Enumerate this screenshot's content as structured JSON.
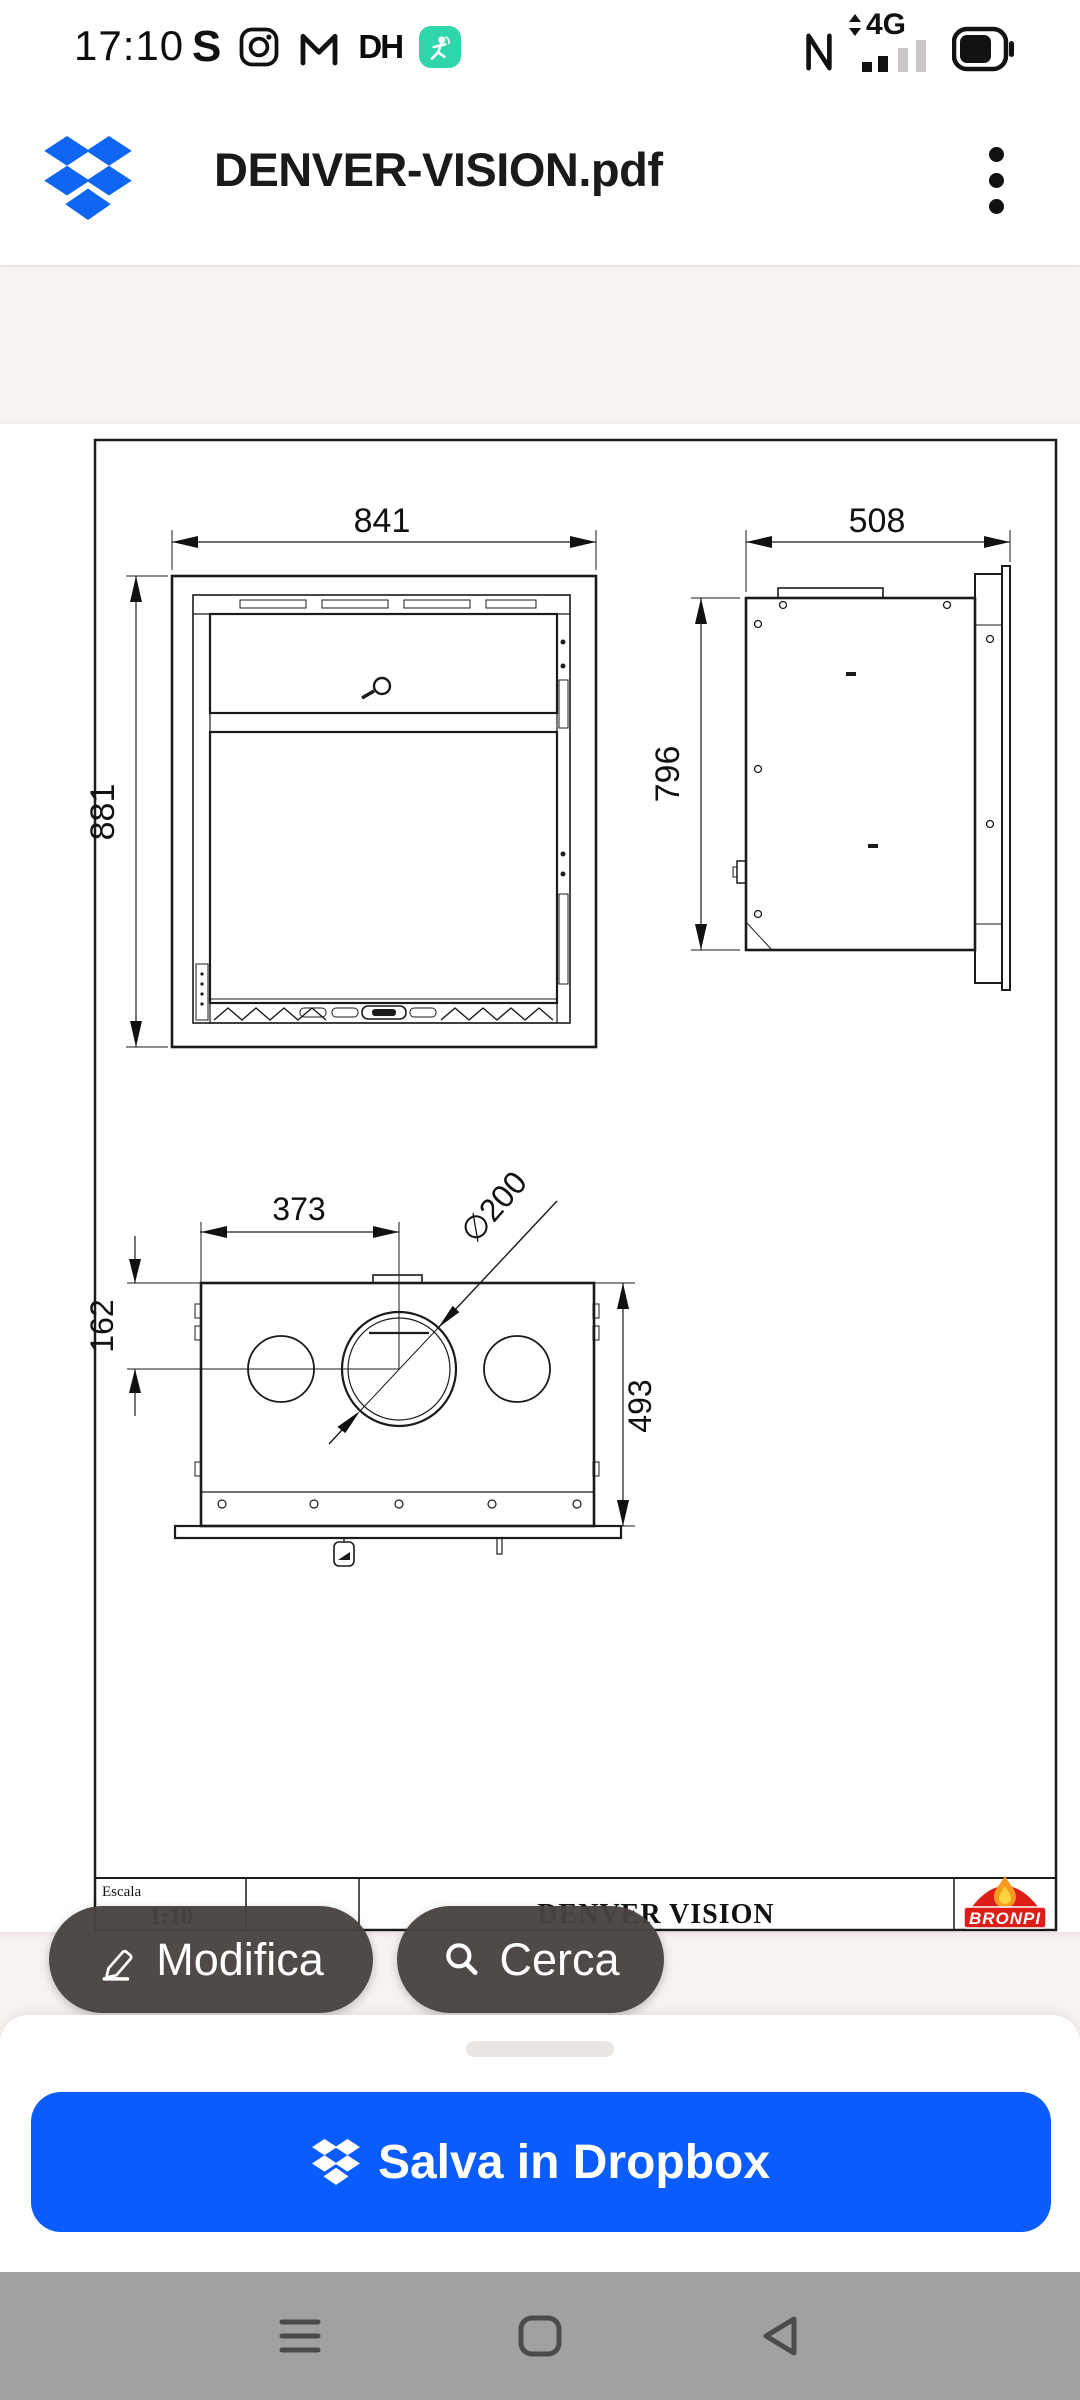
{
  "status_bar": {
    "time": "17:10",
    "nfc_icon": "N",
    "network": "4G"
  },
  "header": {
    "title": "DENVER-VISION.pdf"
  },
  "document": {
    "front_view": {
      "width": "841",
      "height": "881"
    },
    "side_view": {
      "width": "508",
      "height": "796"
    },
    "plan_view": {
      "offset_x": "373",
      "offset_y": "162",
      "depth": "493",
      "diameter": "∅200"
    },
    "title_block": {
      "scale_label": "Escala",
      "scale_value": "1:10",
      "model": "DENVER VISION",
      "brand": "BRONPI"
    }
  },
  "actions": {
    "edit": "Modifica",
    "search": "Cerca"
  },
  "bottom_sheet": {
    "save": "Salva in Dropbox"
  },
  "colors": {
    "dropbox_blue": "#0f66f2",
    "save_button_blue": "#0b5cfe",
    "pill_gray": "#484240",
    "brand_red": "#dd1d18",
    "fitness_teal": "#2fd6ac",
    "page_background": "#f8f2f0"
  }
}
